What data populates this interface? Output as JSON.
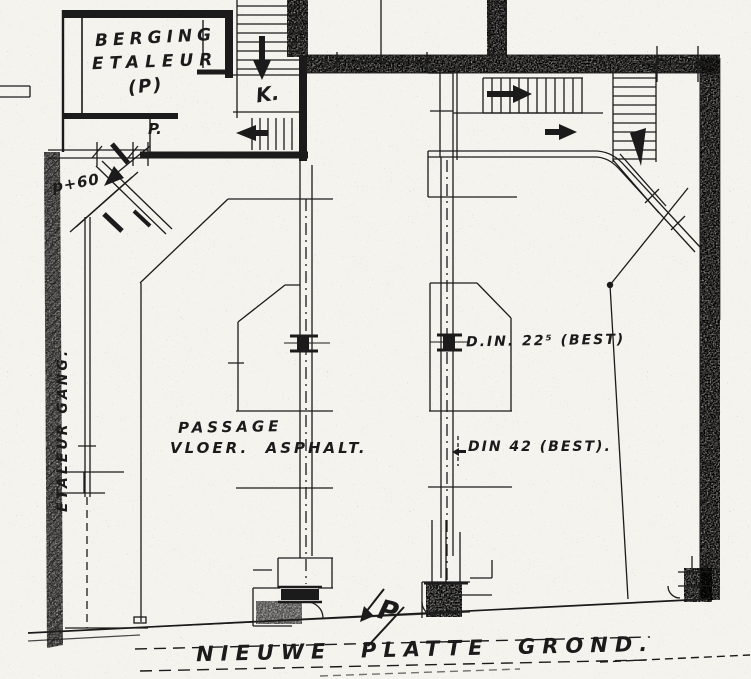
{
  "colors": {
    "paper": "#f5f3ee",
    "ink": "#1b1b1b",
    "wall_fill": "#b7b3ac"
  },
  "plan": {
    "rooms": {
      "storage": {
        "line1": "BERGING",
        "line2": "ETALEUR",
        "line3": "(P)"
      },
      "stair_label": "K.",
      "door_label": "P.",
      "level_label": "p+60",
      "corridor_label": "ETALEUR GANG.",
      "passage": {
        "line1": "PASSAGE",
        "line2": "VLOER.  ASPHALT."
      },
      "beam_upper": "D.IN. 22⁵ (BEST)",
      "beam_lower": "DIN 42 (BEST).",
      "entry_marker": "P"
    },
    "title": "NIEUWE  PLATTE  GROND.",
    "icons": {
      "stair_down_arrow": "filled black arrow ▼",
      "stair_left_arrow": "filled black arrow ◀",
      "stair_right_arrow": "filled black arrow ▶",
      "entrance_arrow": "filled black arrow ◣",
      "entry_p_arrow": "filled black arrow ↙",
      "beam_ref_arrow": "small arrow ◁"
    }
  }
}
